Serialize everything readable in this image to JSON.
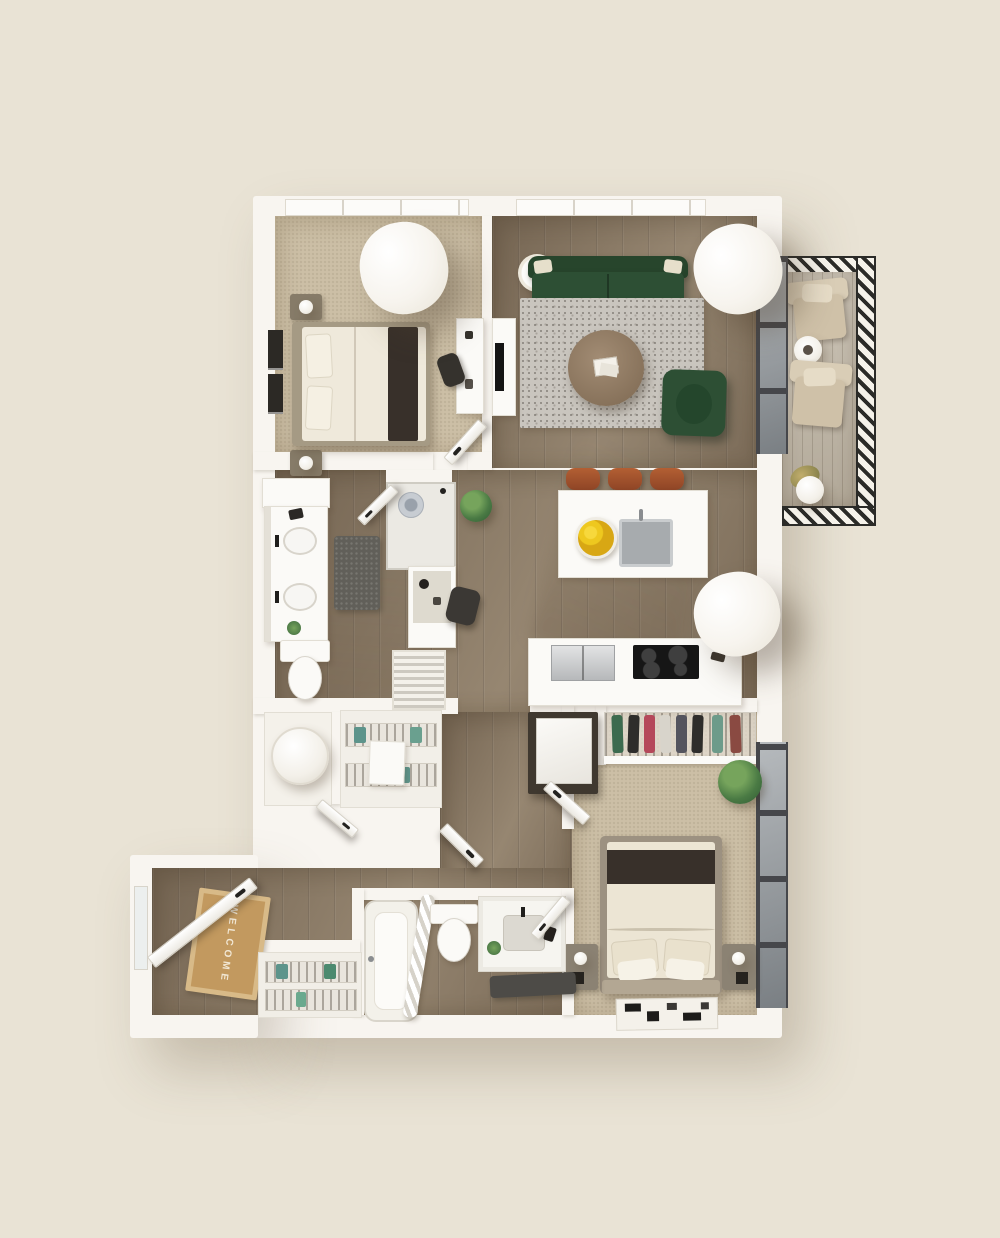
{
  "scene": {
    "kind": "3d-rendered-apartment-floor-plan",
    "view": "top-down"
  },
  "entry": {
    "welcome_mat_text": "WELCOME"
  },
  "colors": {
    "background": "#e9e3d5",
    "wall": "#f8f5f0",
    "wood": "#8a7a66",
    "wood_dark": "#6f5f4d",
    "carpet": "#ccbfa6",
    "rug_gray": "#c9c5be",
    "shag": "#615f59",
    "sofa_green": "#2d4f34",
    "stool": "#a85a33",
    "lemon": "#eec81f",
    "steel": "#c3c5c6",
    "cooktop": "#161616",
    "glass_frame": "#46474b",
    "glass_pane": "#8f959a",
    "deck": "#c4bbab",
    "hatch_dark": "#2b2b28",
    "mat_face": "#c2995f",
    "mat_border": "#d8ba88",
    "welcome_text": "#f1e7d4",
    "teal_towel": "#5d948b",
    "plant_green": "#4a7a44",
    "bed_blanket": "#38302a",
    "duvet": "#ece5d4"
  },
  "rooms": [
    {
      "name": "bedroom-1",
      "floor": "carpet",
      "furniture": [
        "bed",
        "nightstand-lamp",
        "nightstand-lamp",
        "wall-art",
        "desk",
        "desk-chair",
        "ceiling-light-cylinder",
        "window"
      ]
    },
    {
      "name": "living-room",
      "floor": "wood",
      "furniture": [
        "green-sofa",
        "area-rug",
        "round-coffee-table",
        "green-armchair",
        "floor-lamp",
        "tv-console",
        "ceiling-light-cylinder",
        "window",
        "glass-door-to-balcony"
      ]
    },
    {
      "name": "kitchen",
      "floor": "wood",
      "furniture": [
        "island-with-sink",
        "lemon-bowl",
        "bar-stool",
        "bar-stool",
        "bar-stool",
        "refrigerator",
        "cooktop-range",
        "counter",
        "ceiling-light-cylinder"
      ]
    },
    {
      "name": "primary-bathroom",
      "floor": "wood",
      "furniture": [
        "double-sink-vanity",
        "walk-in-shower",
        "toilet",
        "shag-mat",
        "makeup-desk",
        "desk-chair",
        "louver-closet",
        "plant"
      ]
    },
    {
      "name": "closets-and-laundry",
      "floor": "wood",
      "furniture": [
        "water-heater",
        "wire-shelving-towels",
        "storage-box",
        "stacked-washer-dryer"
      ]
    },
    {
      "name": "entry",
      "floor": "wood",
      "furniture": [
        "welcome-mat",
        "open-front-door",
        "wire-shelf-closet"
      ]
    },
    {
      "name": "bathroom-2",
      "floor": "wood",
      "furniture": [
        "bathtub",
        "shower-curtain",
        "toilet",
        "sink-vanity",
        "dark-mat",
        "plant"
      ]
    },
    {
      "name": "bedroom-2",
      "floor": "carpet",
      "furniture": [
        "bed",
        "nightstand-lamp",
        "nightstand-lamp",
        "closet-hanging-clothes",
        "patterned-rug",
        "plant",
        "floor-to-ceiling-windows"
      ]
    },
    {
      "name": "balcony",
      "floor": "deck",
      "furniture": [
        "lounge-chair",
        "lounge-chair",
        "side-table",
        "potted-plant",
        "hatched-railing"
      ]
    }
  ]
}
